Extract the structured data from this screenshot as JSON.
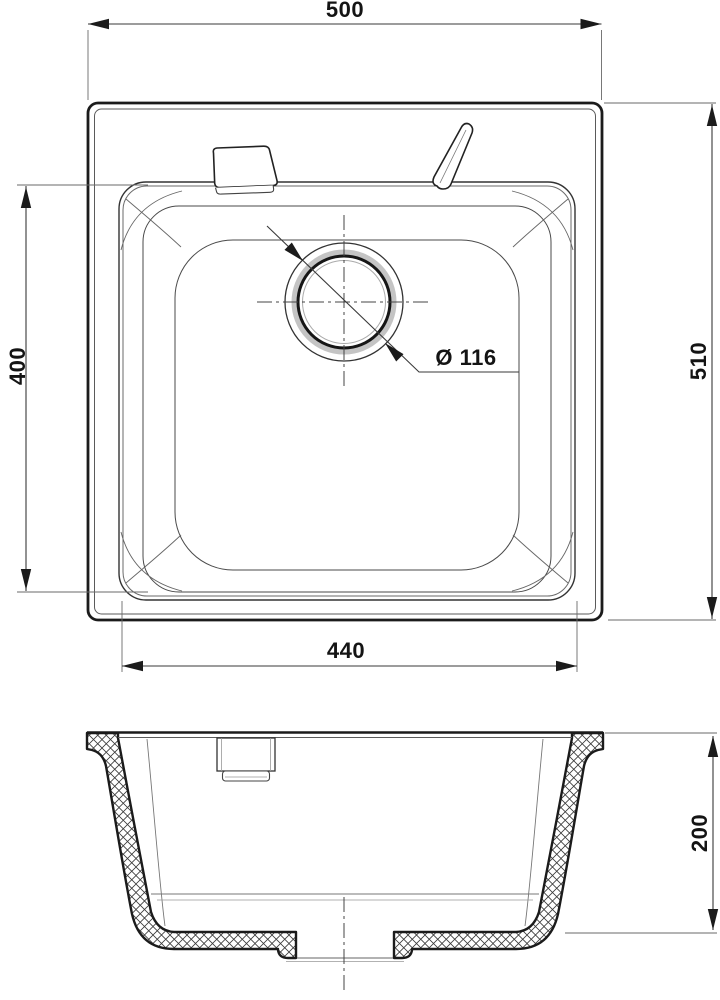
{
  "drawing": {
    "subject": "kitchen-sink-technical-drawing",
    "views": {
      "plan": "top view of square sink with drain",
      "section": "front cross-section of sink bowl"
    },
    "colors": {
      "background": "#ffffff",
      "outline": "#1b1b1b",
      "thin_line": "#5a5a5a",
      "dimension_line": "#3a3a3a",
      "drain_ring_shade": "#c4c4c4"
    },
    "dimensions": {
      "top_width": "500",
      "right_height": "510",
      "left_height": "400",
      "bottom_width": "440",
      "drain_diameter": "Ø 116",
      "section_depth": "200"
    }
  }
}
